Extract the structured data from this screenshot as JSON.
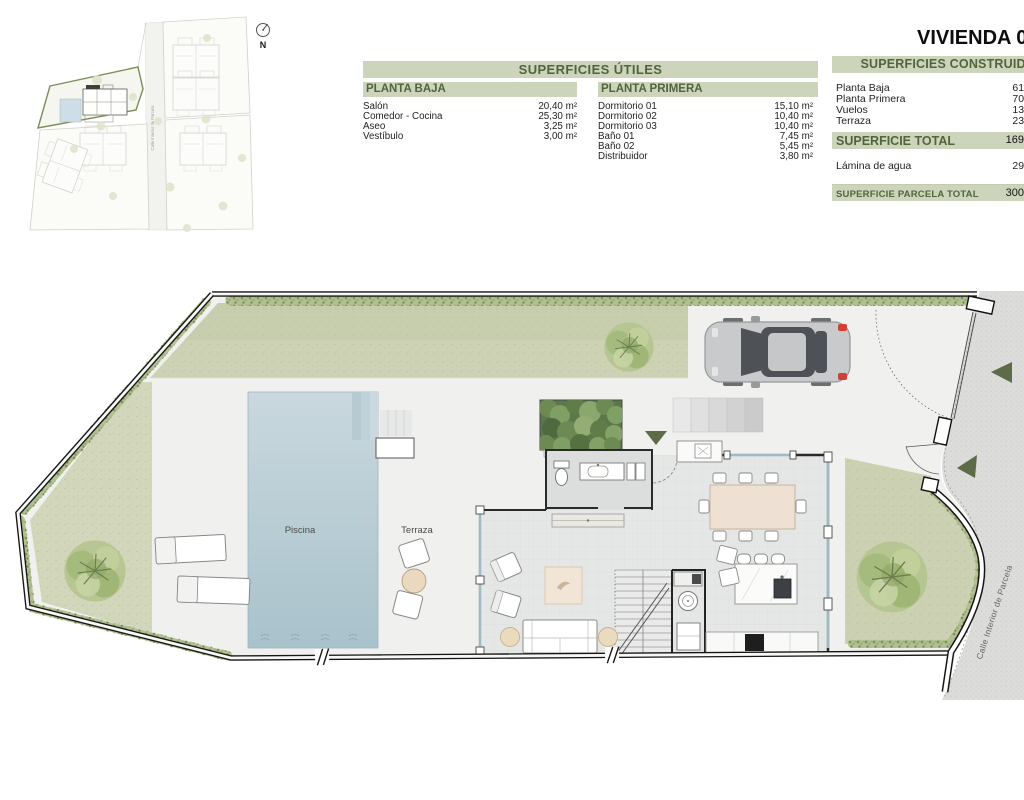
{
  "title": "VIVIENDA 0",
  "compass": {
    "north_label": "N"
  },
  "site_plan": {
    "street_label": "Calle Interior de Parcela"
  },
  "tables": {
    "utiles": {
      "header": "SUPERFICIES ÚTILES",
      "planta_baja": {
        "header": "PLANTA BAJA",
        "rows": [
          {
            "label": "Salón",
            "value": "20,40 m²"
          },
          {
            "label": "Comedor - Cocina",
            "value": "25,30 m²"
          },
          {
            "label": "Aseo",
            "value": "3,25 m²"
          },
          {
            "label": "Vestíbulo",
            "value": "3,00 m²"
          }
        ]
      },
      "planta_primera": {
        "header": "PLANTA PRIMERA",
        "rows": [
          {
            "label": "Dormitorio 01",
            "value": "15,10 m²"
          },
          {
            "label": "Dormitorio 02",
            "value": "10,40 m²"
          },
          {
            "label": "Dormitorio 03",
            "value": "10,40 m²"
          },
          {
            "label": "Baño 01",
            "value": "7,45 m²"
          },
          {
            "label": "Baño 02",
            "value": "5,45 m²"
          },
          {
            "label": "Distribuidor",
            "value": "3,80 m²"
          }
        ]
      }
    },
    "construidas": {
      "header": "SUPERFICIES CONSTRUIDAS",
      "rows": [
        {
          "label": "Planta Baja",
          "value": "61,"
        },
        {
          "label": "Planta Primera",
          "value": "70,"
        },
        {
          "label": "Vuelos",
          "value": "13,"
        },
        {
          "label": "Terraza",
          "value": "23,"
        }
      ],
      "total": {
        "label": "SUPERFICIE TOTAL",
        "value": "169,"
      },
      "lamina": {
        "label": "Lámina de agua",
        "value": "29,"
      },
      "parcela": {
        "label": "SUPERFICIE PARCELA TOTAL",
        "value": "300,"
      }
    }
  },
  "plan": {
    "pool_label": "Piscina",
    "terrace_label": "Terraza",
    "street_label": "Calle Interior de Parcela"
  },
  "colors": {
    "table_bar": "#ccd5bc",
    "table_bar_text": "#51643c",
    "lawn": "#cdd2b4",
    "pool": "#b9cdd6",
    "street": "#dcdcda",
    "arrow_green": "#5d6b48",
    "car_red": "#d24036"
  }
}
